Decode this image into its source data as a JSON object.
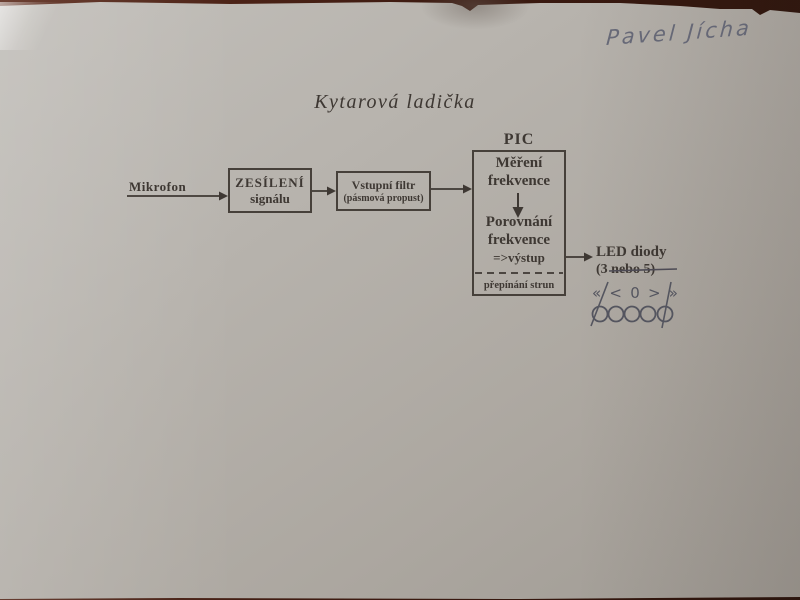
{
  "photo": {
    "handwritten_name": "Pavel Jícha",
    "title": "Kytarová ladička"
  },
  "diagram": {
    "input_label": "Mikrofon",
    "amplifier_box": {
      "line1": "ZESÍLENÍ",
      "line2": "signálu"
    },
    "filter_box": {
      "line1": "Vstupní filtr",
      "line2": "(pásmová propust)"
    },
    "pic": {
      "label": "PIC",
      "step1_line1": "Měření",
      "step1_line2": "frekvence",
      "step2_line1": "Porovnání",
      "step2_line2": "frekvence",
      "step2_line3": "=>výstup",
      "footer": "přepínání strun"
    },
    "output": {
      "label": "LED diody",
      "count_prefix": "(3 ",
      "count_struck": "nebo 5)"
    },
    "led_symbols": [
      "«",
      "<",
      "0",
      ">",
      "»"
    ]
  },
  "colors": {
    "background_table": "#3f1c12",
    "paper": "#b3afa9",
    "printed_ink": "#3e3833",
    "handwriting_ink": "#5a5d6f",
    "pen_marks": "#54555f"
  }
}
